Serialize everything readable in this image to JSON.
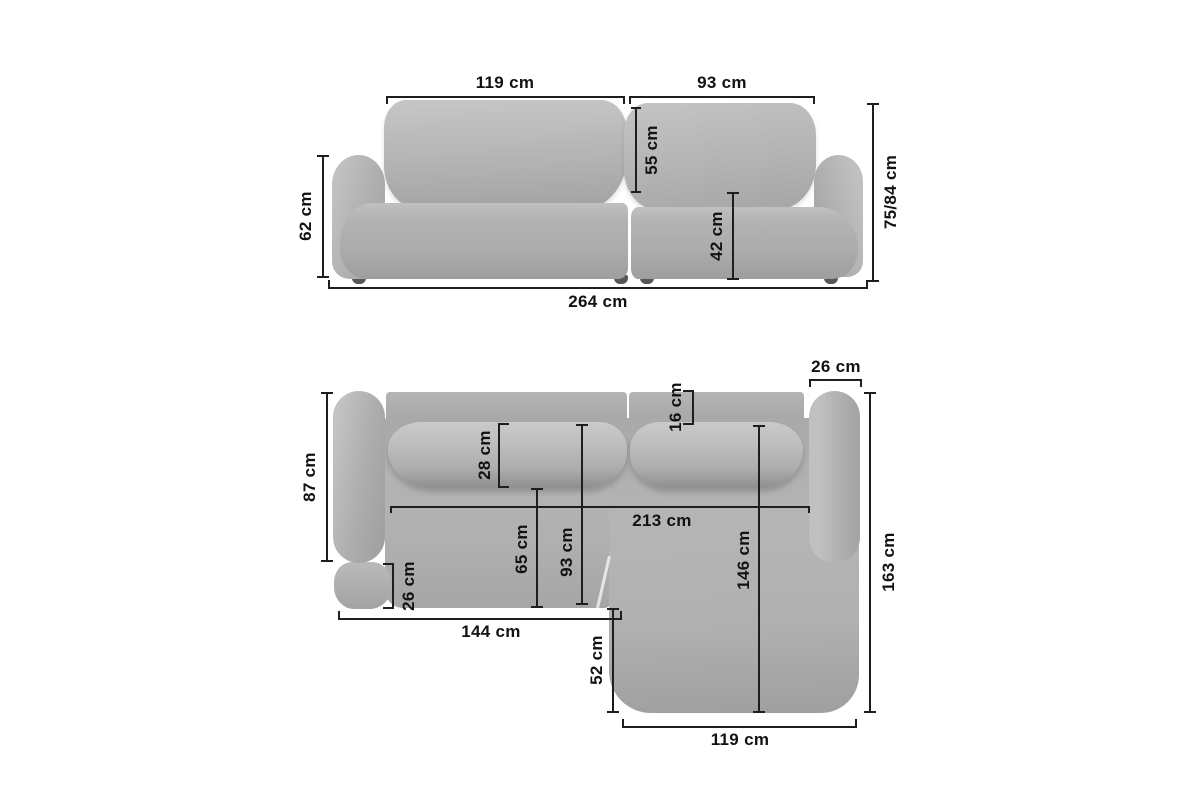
{
  "diagram": {
    "subject": "corner-sofa-dimension-diagram",
    "views": [
      "front-elevation",
      "top-plan"
    ]
  },
  "front_view": {
    "dims": {
      "left_cushion_width": "119 cm",
      "right_cushion_width": "93 cm",
      "back_cushion_height": "55 cm",
      "side_height": "62 cm",
      "seat_height": "42 cm",
      "total_height": "75/84 cm",
      "total_width": "264 cm"
    }
  },
  "top_view": {
    "dims": {
      "right_armrest_width": "26 cm",
      "backrest_depth": "16 cm",
      "body_depth": "87 cm",
      "back_cushion_depth": "28 cm",
      "inner_width": "213 cm",
      "seat_depth": "65 cm",
      "seat_depth_total": "93 cm",
      "chaise_inner_length": "146 cm",
      "left_armrest_front_depth": "26 cm",
      "left_section_width": "144 cm",
      "chaise_extension": "52 cm",
      "total_depth": "163 cm",
      "chaise_width": "119 cm"
    }
  },
  "colors": {
    "background": "#ffffff",
    "sofa_base": "#b0b0b0",
    "sofa_highlight": "#c6c6c6",
    "sofa_shadow": "#9a9a9a",
    "leg": "#565656",
    "dimension_line": "#1e1e1e",
    "text": "#121212"
  }
}
